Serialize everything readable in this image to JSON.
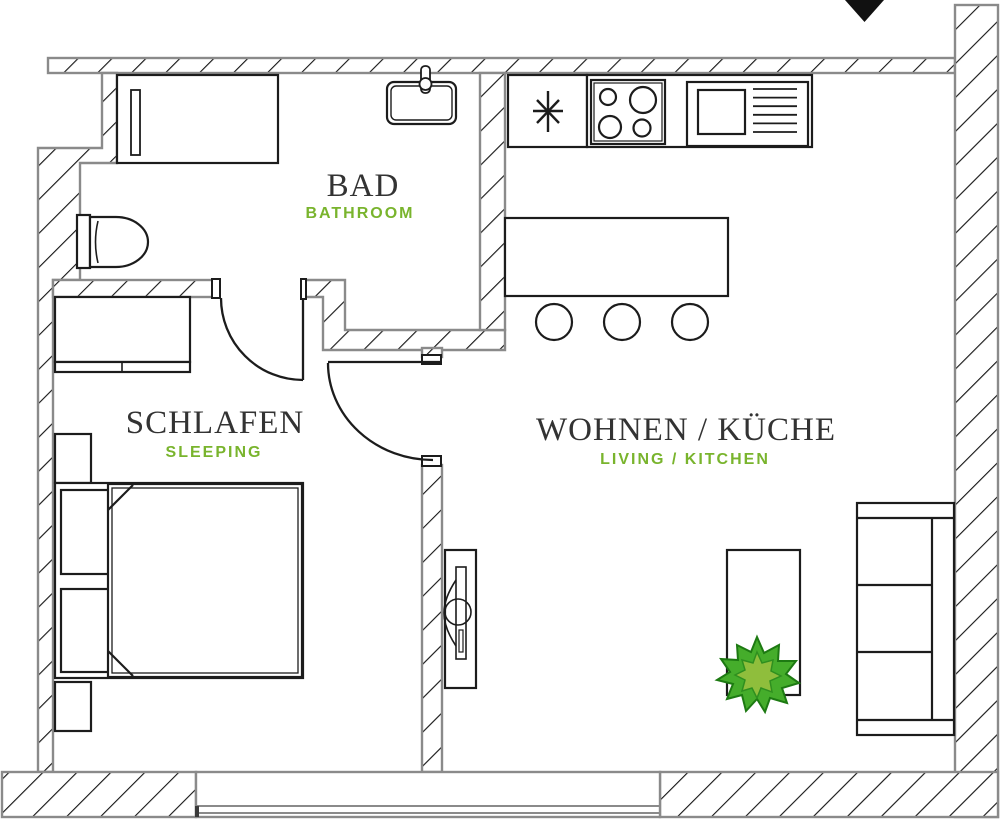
{
  "plan": {
    "title_note": "apartment floor plan",
    "rooms": [
      {
        "name": "BAD",
        "subname": "BATHROOM"
      },
      {
        "name": "SCHLAFEN",
        "subname": "SLEEPING"
      },
      {
        "name": "WOHNEN / KÜCHE",
        "subname": "LIVING / KITCHEN"
      }
    ],
    "colors": {
      "accent_green": "#79b42d",
      "plant_green_dark": "#2f9420",
      "plant_green_light": "#8fbe3c",
      "wall_outline": "#8a8a8a",
      "furniture_line": "#1c1c1c",
      "text_dark": "#333333"
    },
    "icons": {
      "entrance_arrow": "filled triangle pointing down",
      "fridge_asterisk": "8-point asterisk appliance symbol",
      "plant": "potted plant star-leaf symbol"
    }
  }
}
